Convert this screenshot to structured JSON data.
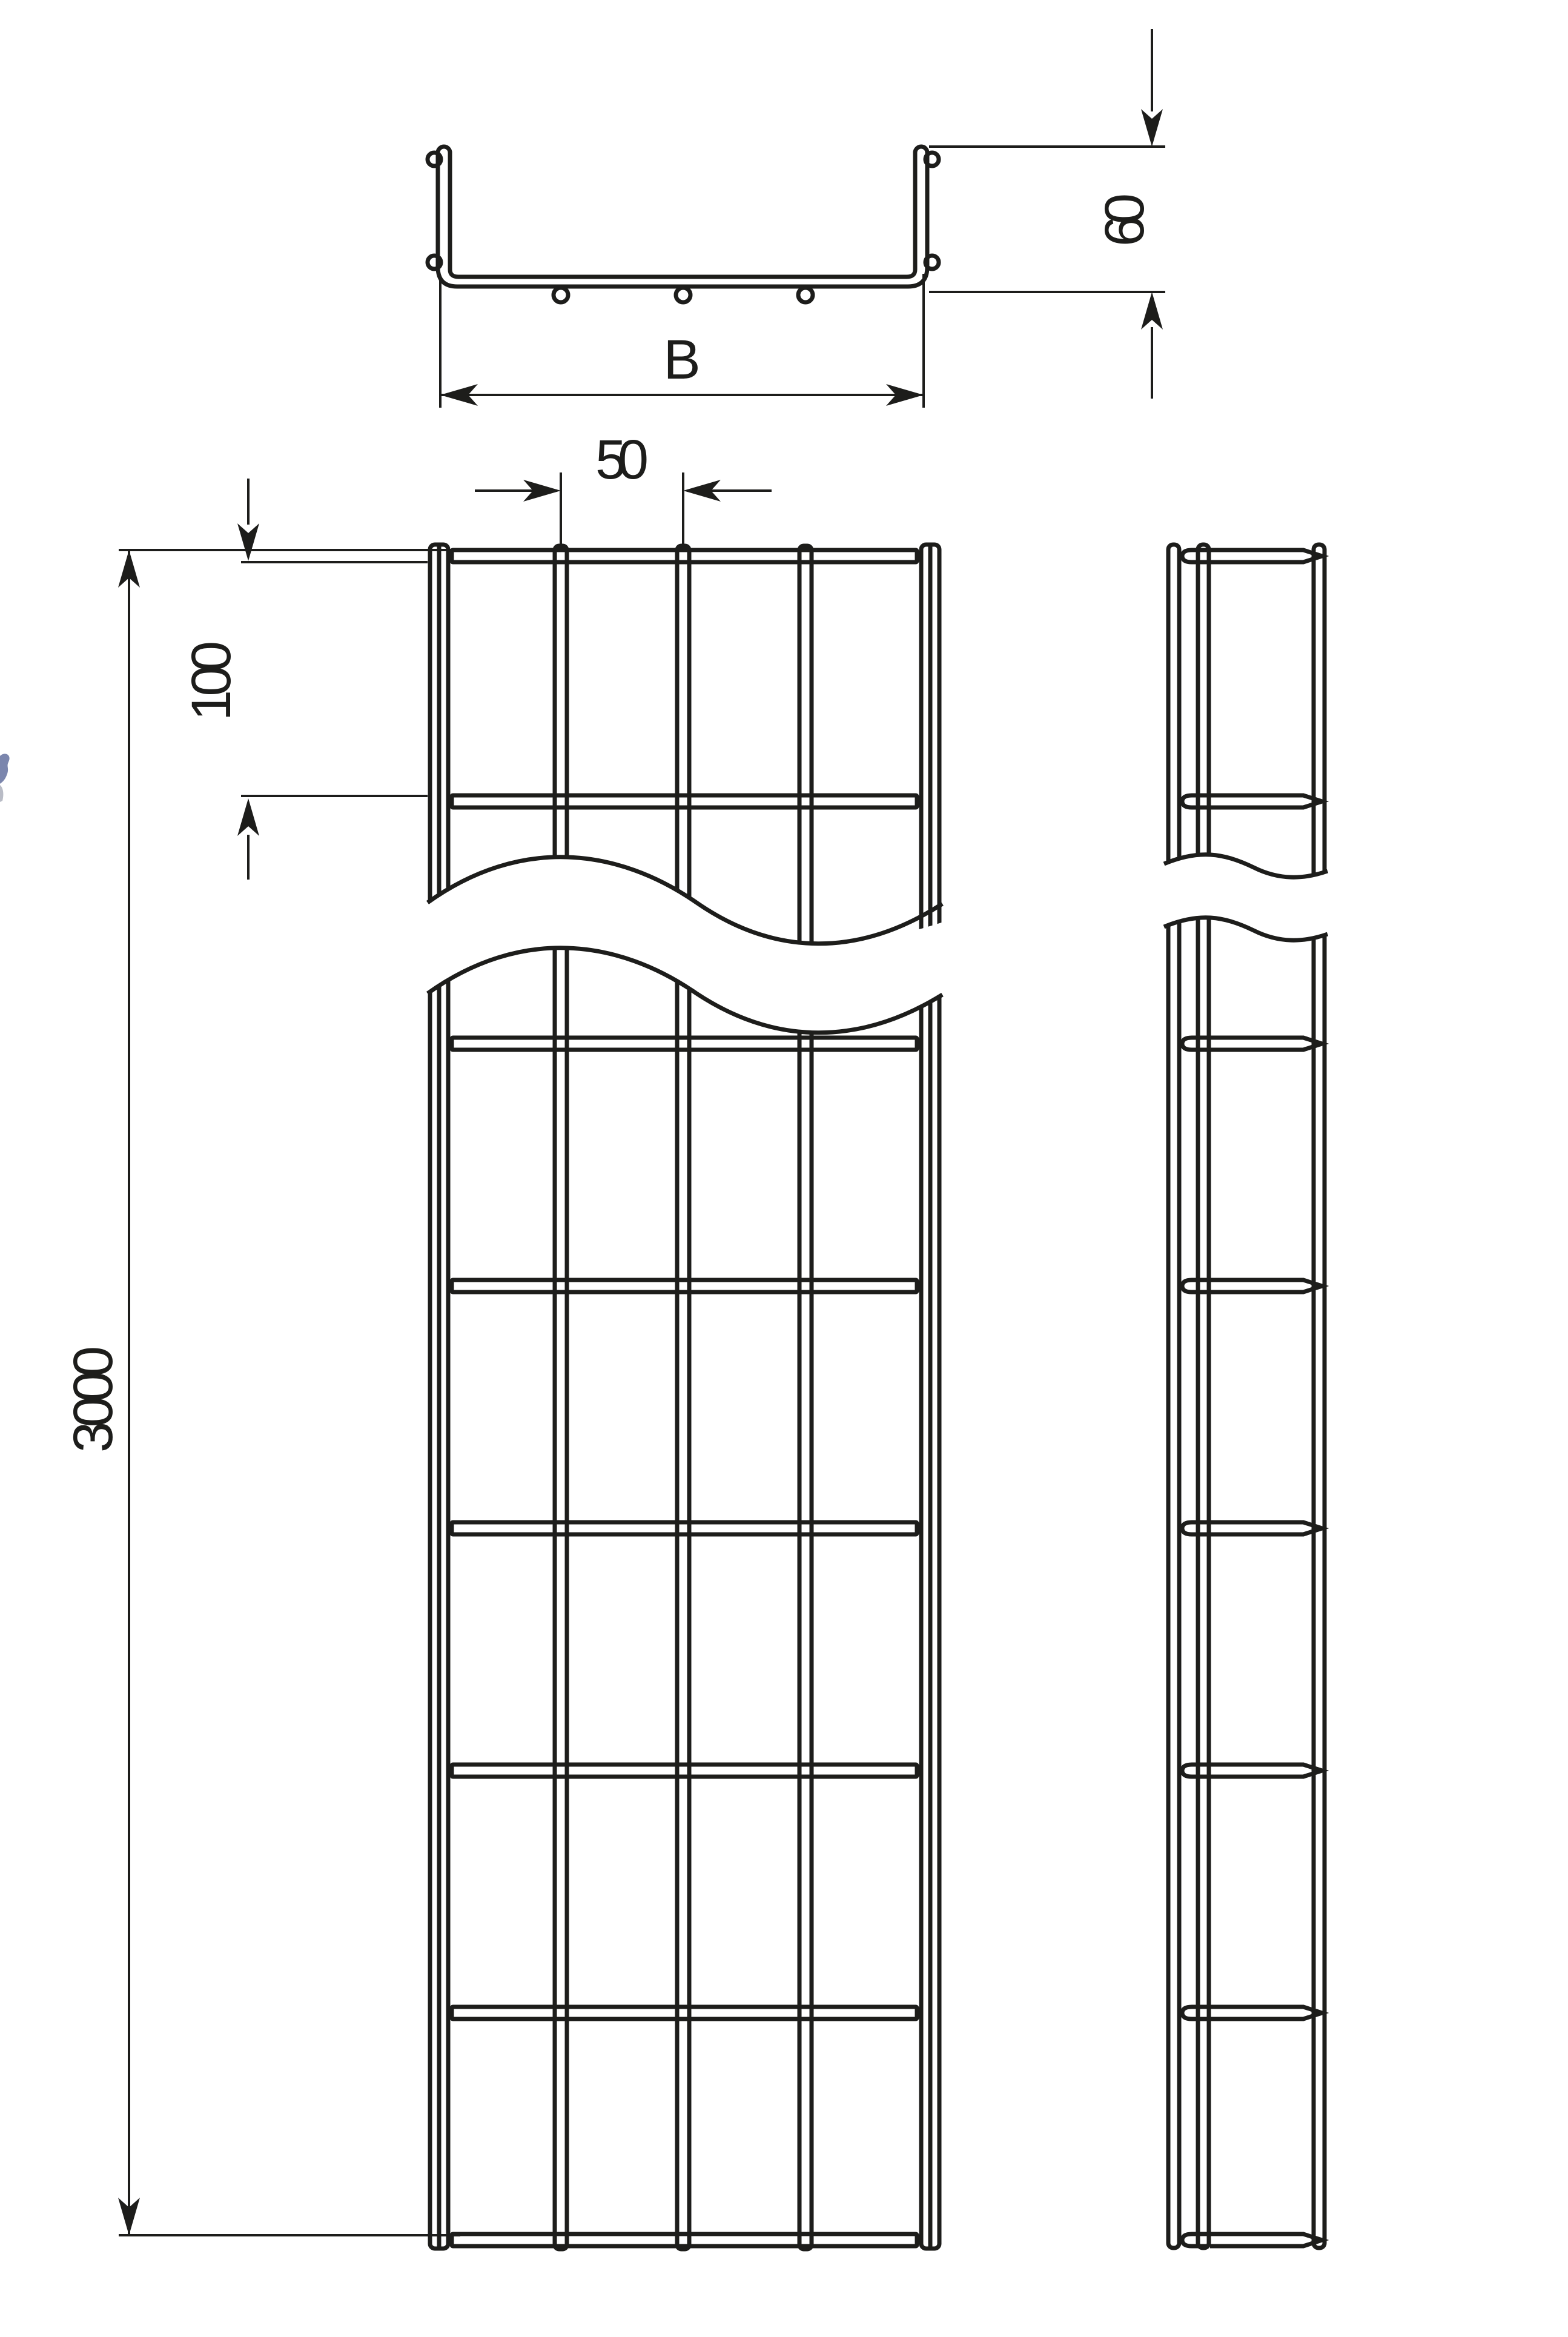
{
  "page": {
    "type": "technical-drawing",
    "background": "#ffffff"
  },
  "colors": {
    "line": "#1d1d1b",
    "artifact_mark": "#7b86ad"
  },
  "labels": {
    "width": "B",
    "height": "60",
    "wire_spacing": "50",
    "cross_wire_pitch": "100",
    "length": "3000"
  },
  "views": {
    "cross_section": {
      "name": "cross-section",
      "annotations": [
        "B",
        "60"
      ],
      "hanging_wire_loops": 3,
      "rim_wire_circles": 4
    },
    "plan": {
      "name": "top-view",
      "annotations": [
        "50",
        "100",
        "3000"
      ],
      "interior_longitudinal_wires": 3,
      "visible_cross_wires": 8,
      "has_break_lines": true
    },
    "side": {
      "name": "side-view",
      "longitudinal_tubes": 3,
      "visible_cross_wires": 8,
      "has_break_lines": true
    }
  }
}
